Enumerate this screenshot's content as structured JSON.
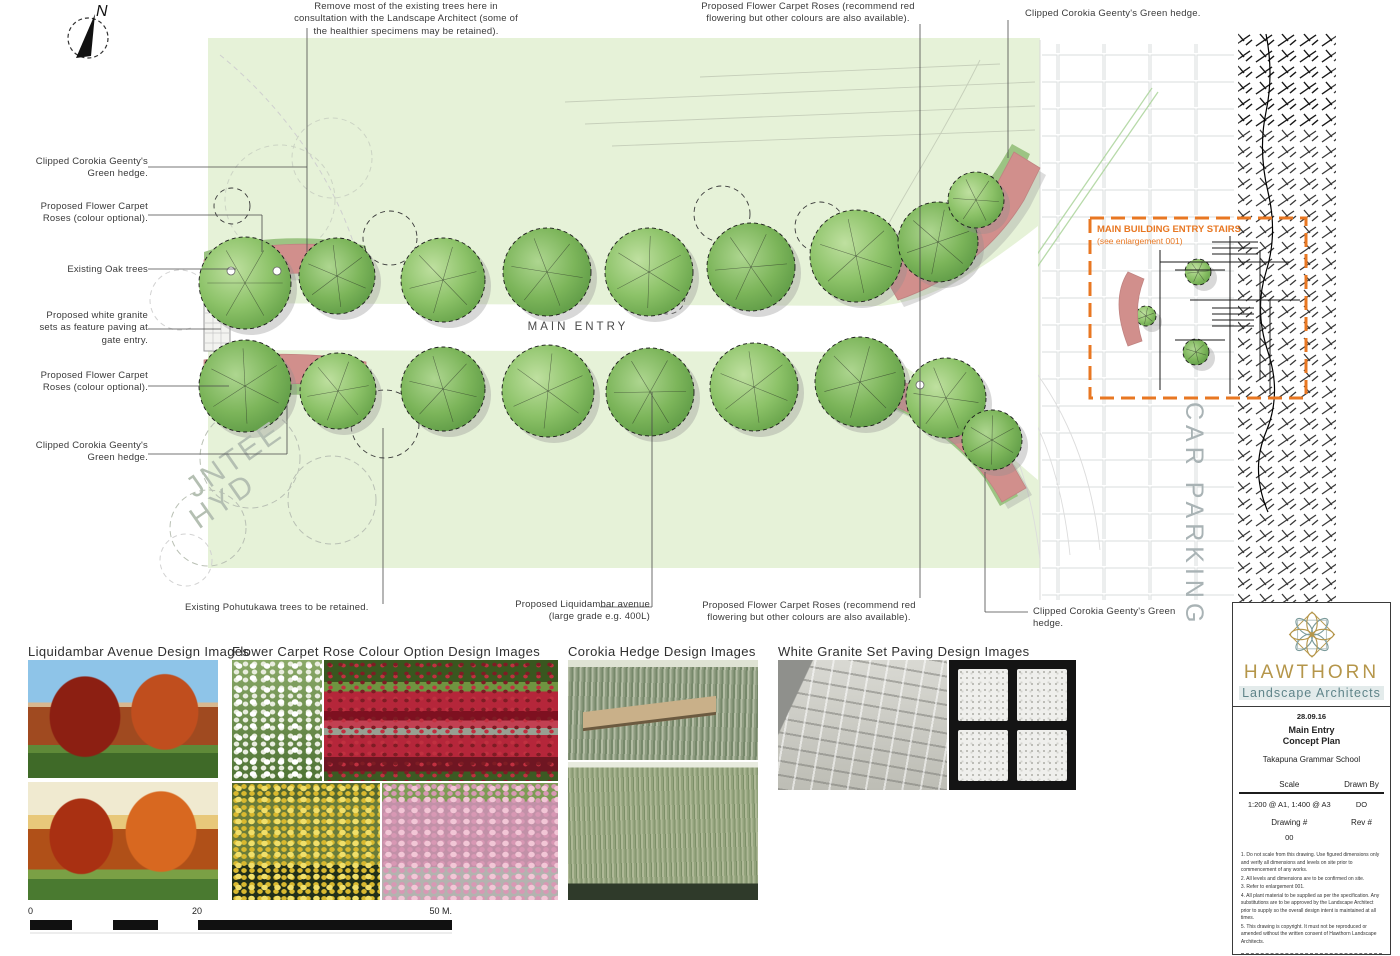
{
  "plan": {
    "main_entry": "MAIN ENTRY",
    "car_parking": "CAR PARKING",
    "survey_word_1": "JNTEE",
    "survey_word_2": "HYD",
    "north": "N",
    "enlargement_line1": "MAIN BUILDING ENTRY STAIRS",
    "enlargement_line2": "(see enlargement 001)"
  },
  "annotations": {
    "remove_trees": "Remove most of the existing trees here in consultation with the Landscape Architect (some of the healthier specimens may be retained).",
    "roses_top": "Proposed Flower Carpet Roses (recommend red flowering but other colours are also available).",
    "corokia_top_right": "Clipped Corokia Geenty's Green hedge.",
    "corokia_left_top": "Clipped Corokia Geenty's Green hedge.",
    "roses_left_top": "Proposed Flower Carpet Roses (colour optional).",
    "existing_oak": "Existing Oak trees",
    "white_granite": "Proposed white granite sets as feature paving at gate entry.",
    "roses_left_bottom": "Proposed Flower Carpet Roses (colour optional).",
    "corokia_left_bottom": "Clipped Corokia Geenty's Green hedge.",
    "pohutukawa": "Existing Pohutukawa trees to be retained.",
    "liquidambar_line1": "Proposed Liquidambar avenue",
    "liquidambar_line2": "(large grade e.g. 400L)",
    "roses_bottom": "Proposed Flower Carpet Roses (recommend red flowering but other colours are also available).",
    "corokia_bottom_right": "Clipped Corokia Geenty's Green hedge."
  },
  "image_sections": {
    "liquidambar_header": "Liquidambar Avenue Design Images",
    "rose_header": "Flower Carpet Rose Colour Option Design Images",
    "corokia_header": "Corokia Hedge Design Images",
    "granite_header": "White Granite Set Paving Design Images"
  },
  "scale_bar": {
    "tick_0": "0",
    "tick_20": "20",
    "tick_50": "50 M."
  },
  "title_block": {
    "firm_name": "HAWTHORN",
    "firm_subtitle": "Landscape Architects",
    "date": "28.09.16",
    "project_line1": "Main Entry",
    "project_line2": "Concept Plan",
    "client": "Takapuna Grammar School",
    "scale_label": "Scale",
    "drawn_by_label": "Drawn By",
    "scale_value": "1:200 @ A1, 1:400 @ A3",
    "drawn_by_value": "DO",
    "drawing_no_label": "Drawing #",
    "rev_label": "Rev #",
    "drawing_no_value": "00",
    "notes": [
      "1. Do not scale from this drawing. Use figured dimensions only and verify all dimensions and levels on site prior to commencement of any works.",
      "2. All levels and dimensions are to be confirmed on site.",
      "3. Refer to enlargement 001.",
      "4. All plant material to be supplied as per the specification. Any substitutions are to be approved by the Landscape Architect prior to supply so the overall design intent is maintained at all times.",
      "5. This drawing is copyright. It must not be reproduced or amended without the written consent of Hawthorn Landscape Architects."
    ]
  },
  "colors": {
    "accent_orange": "#E87722",
    "brand_gold": "#B5964A",
    "brand_teal": "#5F8489",
    "lawn_green": "#E6F2D8",
    "tree_green": "#7DB55C",
    "rose_pink": "#D18F8C"
  }
}
